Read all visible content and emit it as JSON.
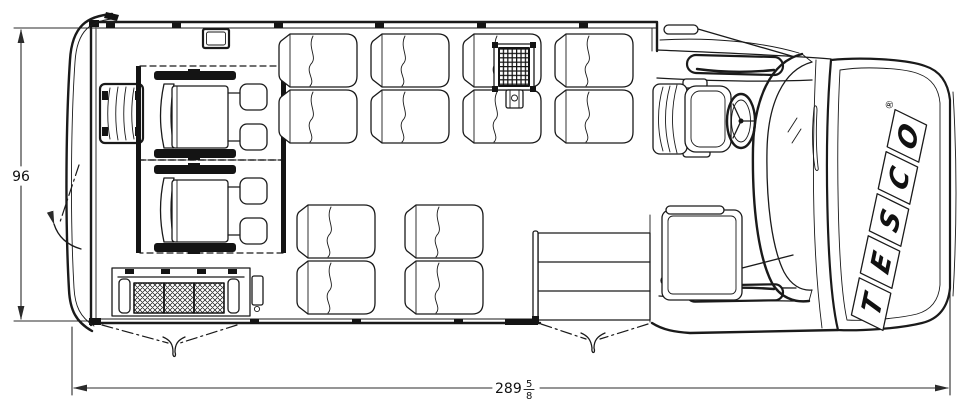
{
  "palette": {
    "line": "#1a1a1a",
    "background": "#ffffff"
  },
  "dimensions": {
    "width": {
      "value": "96"
    },
    "length": {
      "whole": "289",
      "fraction_numerator": "5",
      "fraction_denominator": "8"
    }
  },
  "brand": {
    "name": "TESCO",
    "letters": [
      "T",
      "E",
      "S",
      "C",
      "O"
    ],
    "registered_mark": "®"
  }
}
